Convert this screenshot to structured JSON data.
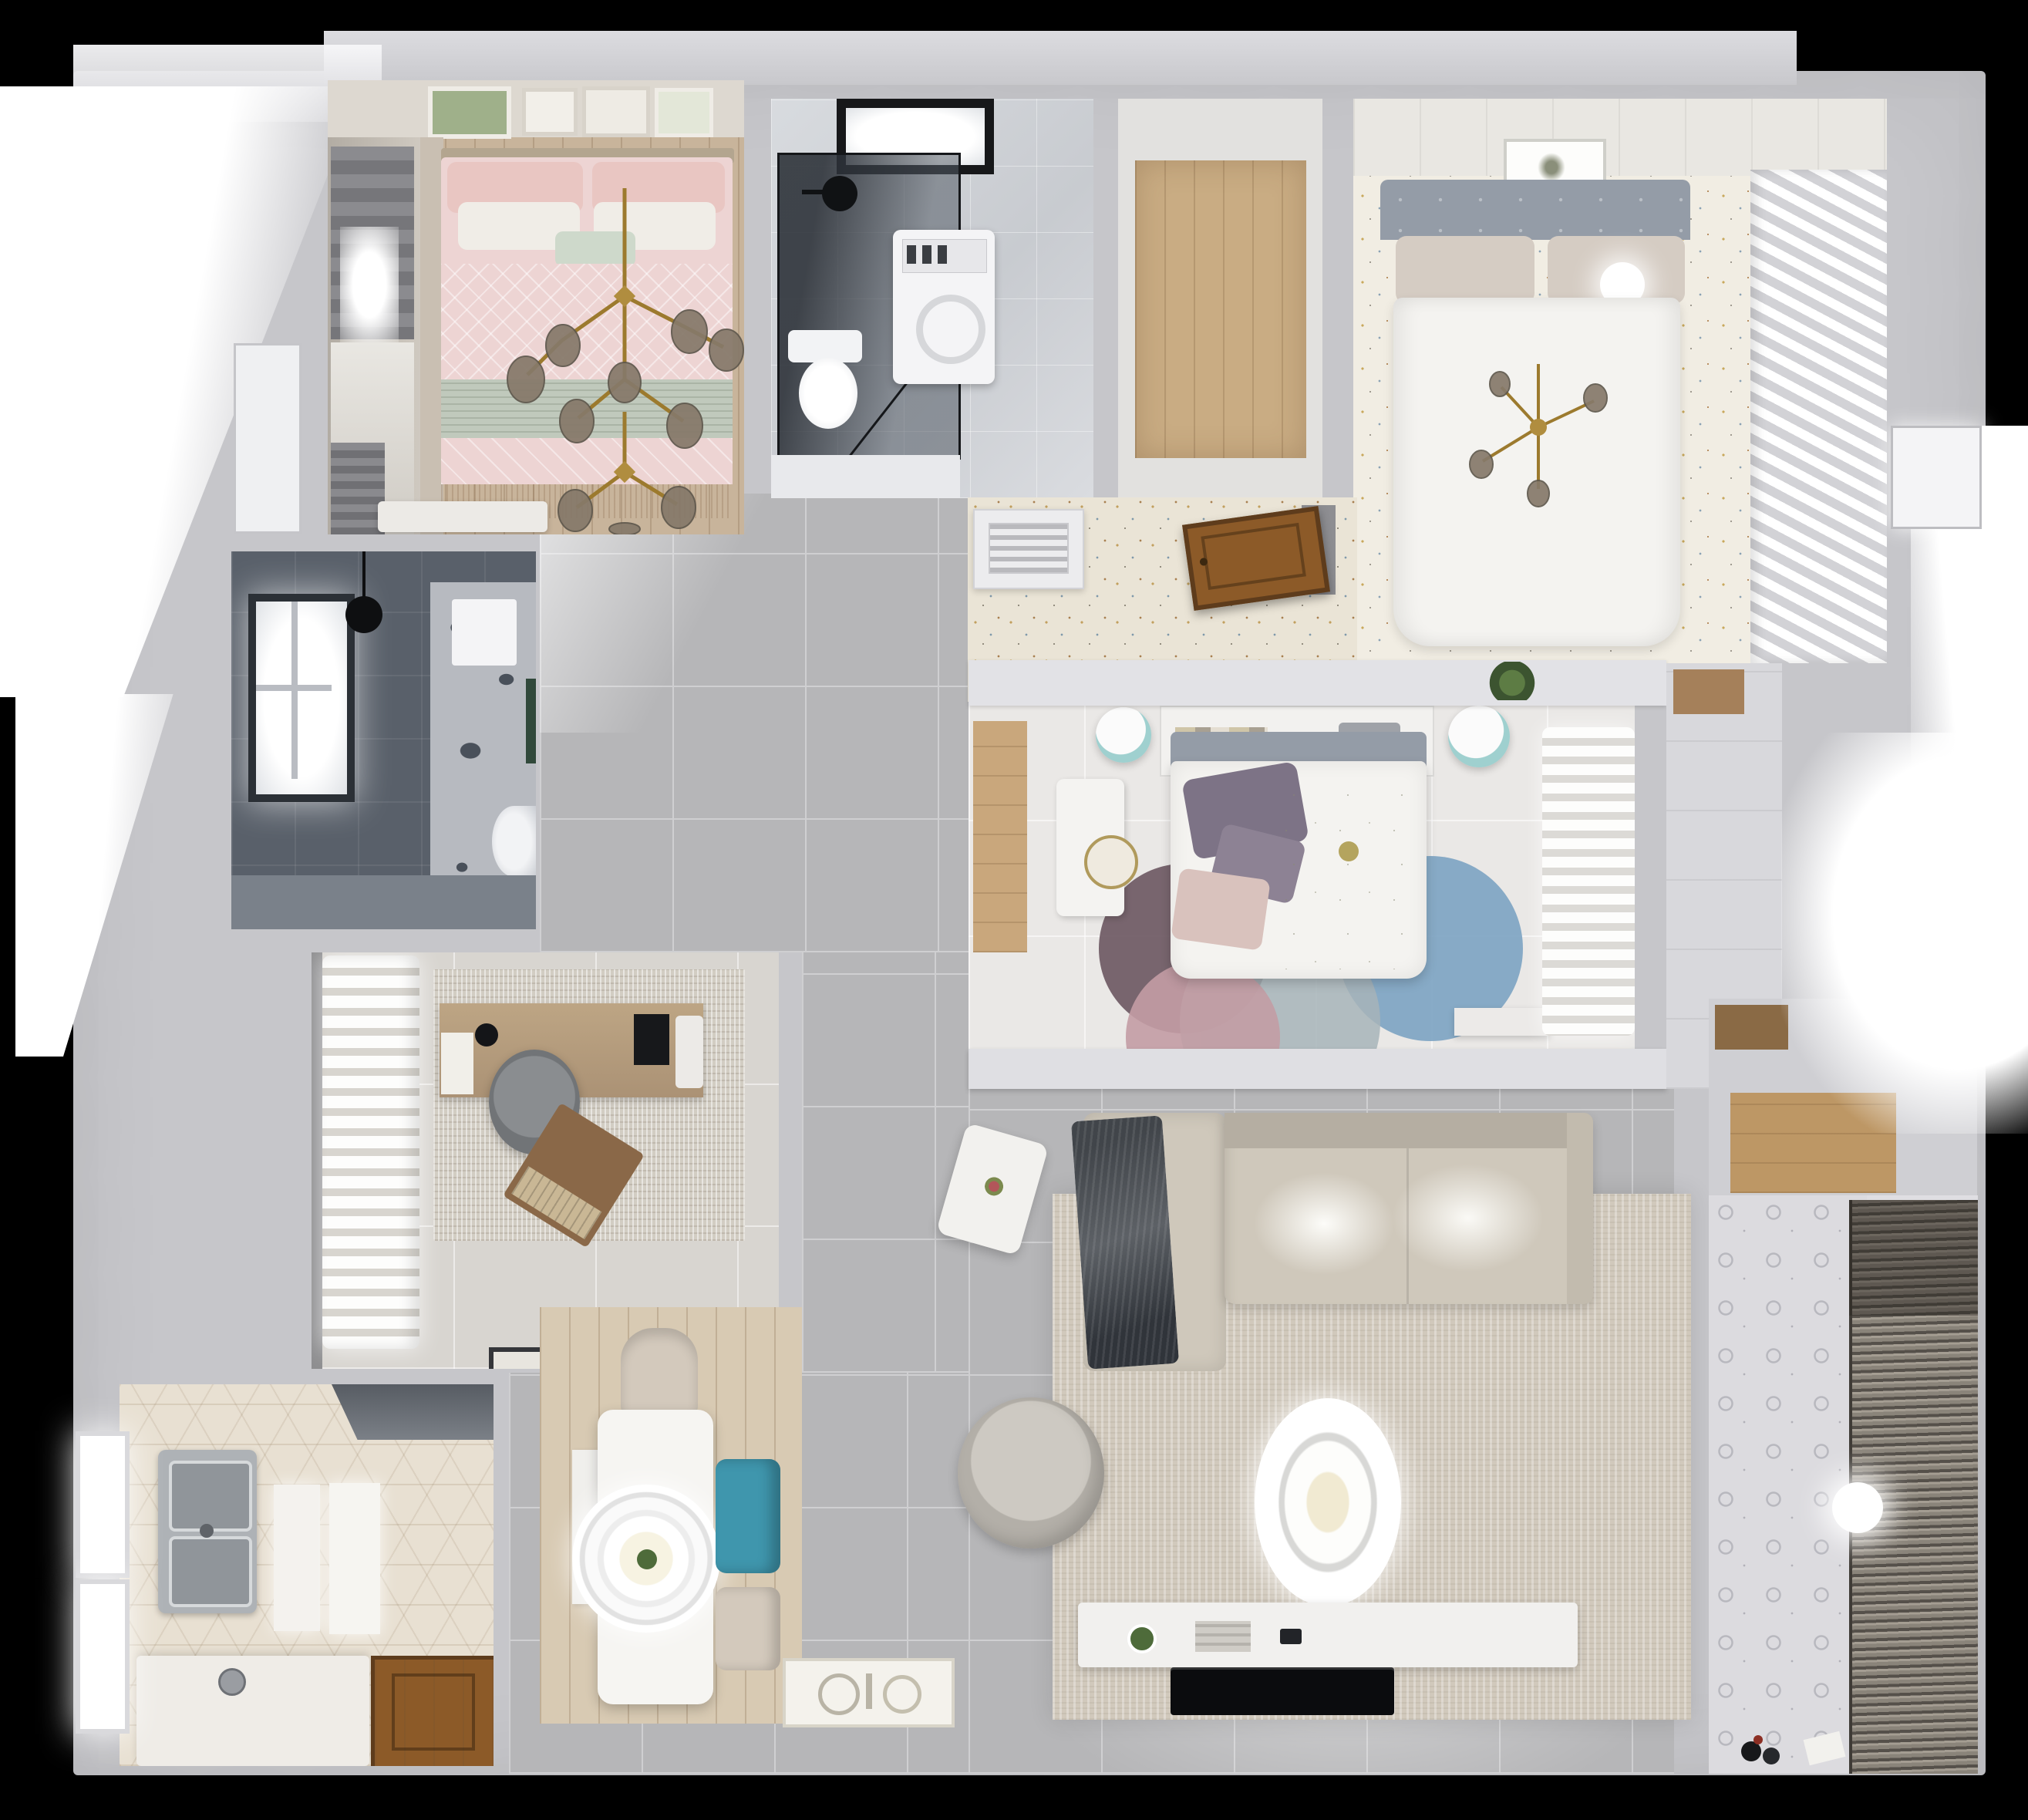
{
  "title": "3D rendered top-down apartment floor plan",
  "colors": {
    "wall": "#c6c6ca",
    "wallLight": "#e2e2e6",
    "wallBand": "#dfdfe3",
    "grout": "#cfcfd1",
    "tileHall": "#b6b6b8",
    "speckle": "#f1ede3",
    "terrazzo": "#eae4d6",
    "hexFloor": "#e8e0d2",
    "rugLiving": "#d1c9bc",
    "sofa": "#cfc8bb",
    "sofaBack": "#b5aea2",
    "throw": "#41454a",
    "woodFloorPink": "#c8b49b",
    "woodCloset": "#c9ac83",
    "woodMid": "#c9a77c",
    "woodNook": "#bd9765",
    "deskWood": "#b49b7e",
    "doorWood": "#8c5a28",
    "doorWoodDark": "#5e3c1c",
    "pinkDuvet": "#edd4d3",
    "pinkPillow": "#e9c6c2",
    "sage": "#c0c9bc",
    "mint": "#ced9cb",
    "headboardTan": "#b3a58f",
    "bathDark": "#59606a",
    "showerGlass": "#3f444c",
    "duvetWhite": "#f4f3f0",
    "headboardGrey": "#949ca7",
    "pillowBeige": "#d5ccc3",
    "chairGrey": "#7e8184",
    "laptopWood": "#8a6848",
    "rugBlue": "#7ca3c2",
    "rugPink": "#c39ca4",
    "rugPlum": "#6b5661",
    "gold": "#9c7a2e",
    "globe": "#86796a",
    "teal": "#3f96ad",
    "tealStool": "#9fd0cf",
    "chairBeige": "#d3c9bc",
    "blindDark": "#55504a",
    "blindLight": "#a49d92",
    "matWood": "#d8cab3",
    "green": "#4e6b3a",
    "tvBlack": "#0b0c0e",
    "white": "#ffffff"
  },
  "rooms": [
    {
      "name": "bedroom-pink",
      "items": [
        "double-bed-pink-bedding",
        "gold-branch-chandelier",
        "roman-shade-window",
        "gallery-frames",
        "white-bench"
      ]
    },
    {
      "name": "bathroom-main",
      "items": [
        "dark-glass-shower",
        "skylight",
        "washing-machine",
        "toilet",
        "rain-shower-head"
      ]
    },
    {
      "name": "closet-top",
      "items": [
        "wood-floor"
      ]
    },
    {
      "name": "bedroom-master",
      "items": [
        "white-double-bed",
        "grey-headboard",
        "ball-lamp",
        "gold-chandelier",
        "slatted-wardrobe",
        "picture-frame",
        "speckled-floor"
      ]
    },
    {
      "name": "entry-hall",
      "items": [
        "terrazzo-floor",
        "vent-cabinet",
        "open-wood-door"
      ]
    },
    {
      "name": "bathroom-dark",
      "items": [
        "backlit-window",
        "black-pendant-lamp",
        "towel",
        "toilet",
        "floral-tile-wall"
      ]
    },
    {
      "name": "study",
      "items": [
        "sheer-curtains",
        "wood-desk",
        "monitor",
        "grey-office-chair",
        "mottled-rug",
        "wood-laptop-tray",
        "doormat"
      ]
    },
    {
      "name": "kitchen",
      "items": [
        "hex-tile-floor",
        "double-steel-sink",
        "backlit-windows",
        "white-counter",
        "wood-door",
        "dark-hood"
      ]
    },
    {
      "name": "dining",
      "items": [
        "white-table",
        "ring-pendant-light",
        "teal-chair",
        "beige-chairs",
        "wood-floor-mat"
      ]
    },
    {
      "name": "living-room",
      "items": [
        "l-shaped-sofa",
        "dark-throw",
        "rotated-side-table",
        "round-armchair",
        "ring-pendant-light",
        "beige-rug",
        "tv-console",
        "flat-tv",
        "k-doormat"
      ]
    },
    {
      "name": "bedroom-middle",
      "items": [
        "floral-duvet-bed",
        "purple-pillows",
        "headboard-shelf-books",
        "white-desk",
        "teal-stools",
        "circle-rug",
        "sheer-curtains",
        "white-bench"
      ]
    },
    {
      "name": "balcony-laundry",
      "items": [
        "patterned-tile-floor",
        "louvered-blinds",
        "round-ceiling-light",
        "floor-toys"
      ]
    },
    {
      "name": "closet-nook",
      "items": [
        "wood-floor",
        "brown-shelf"
      ]
    }
  ]
}
